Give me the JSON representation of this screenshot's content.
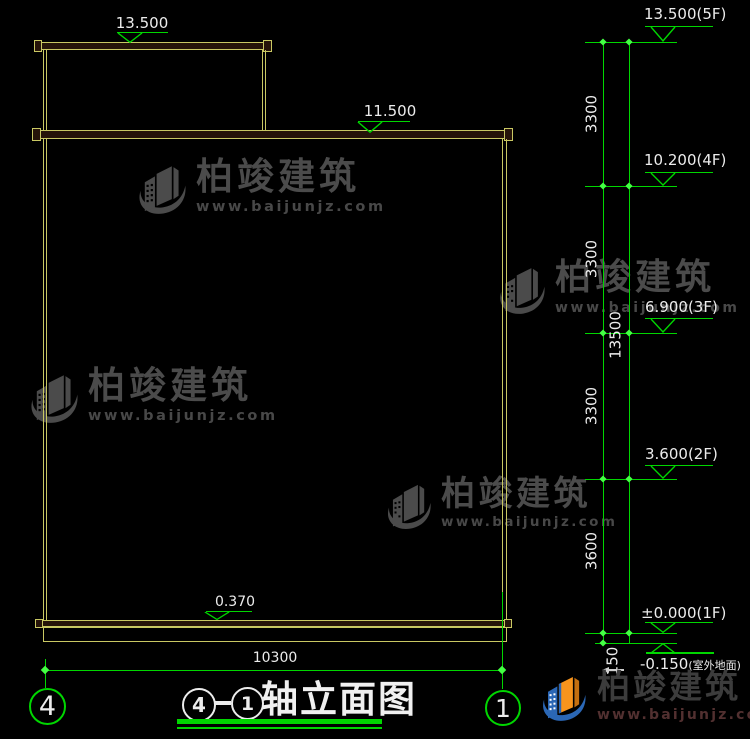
{
  "colors": {
    "background": "#000000",
    "cad_yellow": "#c9c863",
    "cad_green": "#00d600",
    "marker_green": "#44ff44",
    "text_white": "#ececec",
    "watermark_gray": "#4b4b4b",
    "logo_orange": "#f7941d",
    "logo_blue": "#2b67b5"
  },
  "watermark": {
    "brand": "柏竣建筑",
    "url": "www.baijunjz.com"
  },
  "left_view": {
    "markers": [
      {
        "label": "13.500"
      },
      {
        "label": "11.500"
      },
      {
        "label": "0.370"
      }
    ]
  },
  "right_chain": {
    "markers": [
      {
        "label": "13.500(5F)"
      },
      {
        "label": "10.200(4F)"
      },
      {
        "label": "6.900(3F)"
      },
      {
        "label": "3.600(2F)"
      },
      {
        "label": "±0.000(1F)"
      },
      {
        "label": "-0.150",
        "suffix": "(室外地面)"
      }
    ],
    "segments": [
      "3300",
      "3300",
      "3300",
      "3600",
      "150"
    ],
    "total": "13500"
  },
  "bottom": {
    "width_dim": "10300",
    "bubble_left": "4",
    "bubble_right": "1",
    "title": {
      "axis_a": "4",
      "dash": "-",
      "axis_b": "1",
      "text": "轴立面图"
    }
  }
}
